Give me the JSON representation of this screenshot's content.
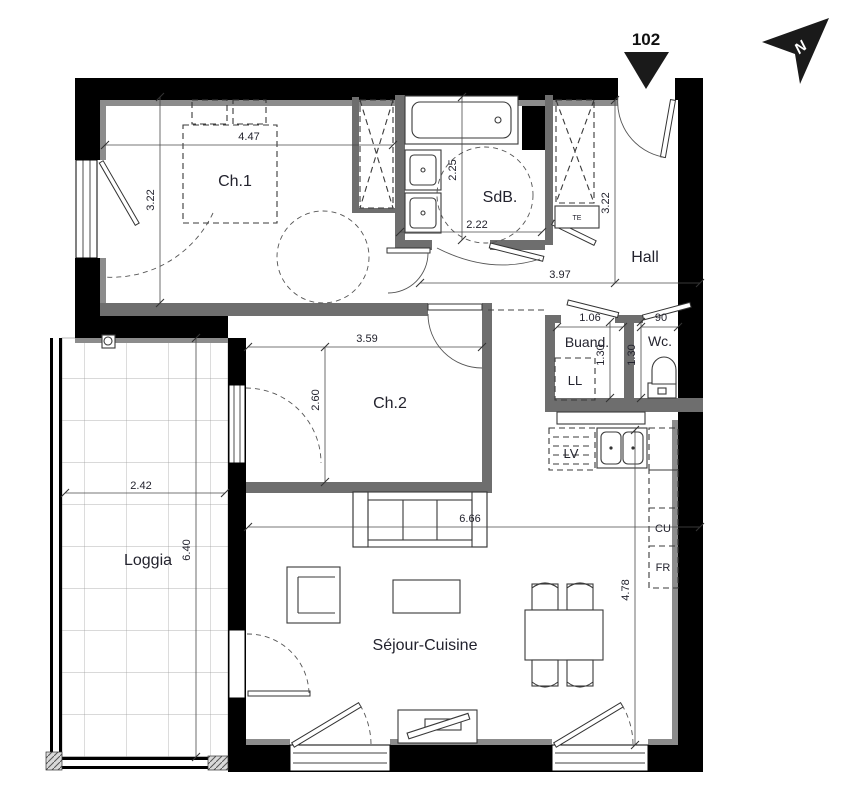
{
  "unit": {
    "number": "102"
  },
  "compass": {
    "label": "N"
  },
  "rooms": {
    "ch1": {
      "name": "Ch.1",
      "width": "4.47",
      "depth": "3.22"
    },
    "sdb": {
      "name": "SdB.",
      "width": "2.22",
      "depth": "2.25"
    },
    "hall": {
      "name": "Hall",
      "width": "3.97",
      "depth": "3.22"
    },
    "buand": {
      "name": "Buand.",
      "width": "1.06",
      "depth": "1.30"
    },
    "wc": {
      "name": "Wc.",
      "width": "90",
      "depth": "1.30"
    },
    "ch2": {
      "name": "Ch.2",
      "width": "3.59",
      "depth": "2.60"
    },
    "loggia": {
      "name": "Loggia",
      "width": "2.42",
      "depth": "6.40"
    },
    "sejour": {
      "name": "Séjour-Cuisine",
      "width": "6.66",
      "depth": "4.78"
    }
  },
  "labels": {
    "ll": "LL",
    "te": "TE",
    "lv": "LV",
    "cu": "CU",
    "fr": "FR"
  },
  "colors": {
    "wall": "#000000",
    "insulation": "#8c8c8c",
    "interior_wall": "#6e6e6e",
    "text": "#23232e"
  }
}
